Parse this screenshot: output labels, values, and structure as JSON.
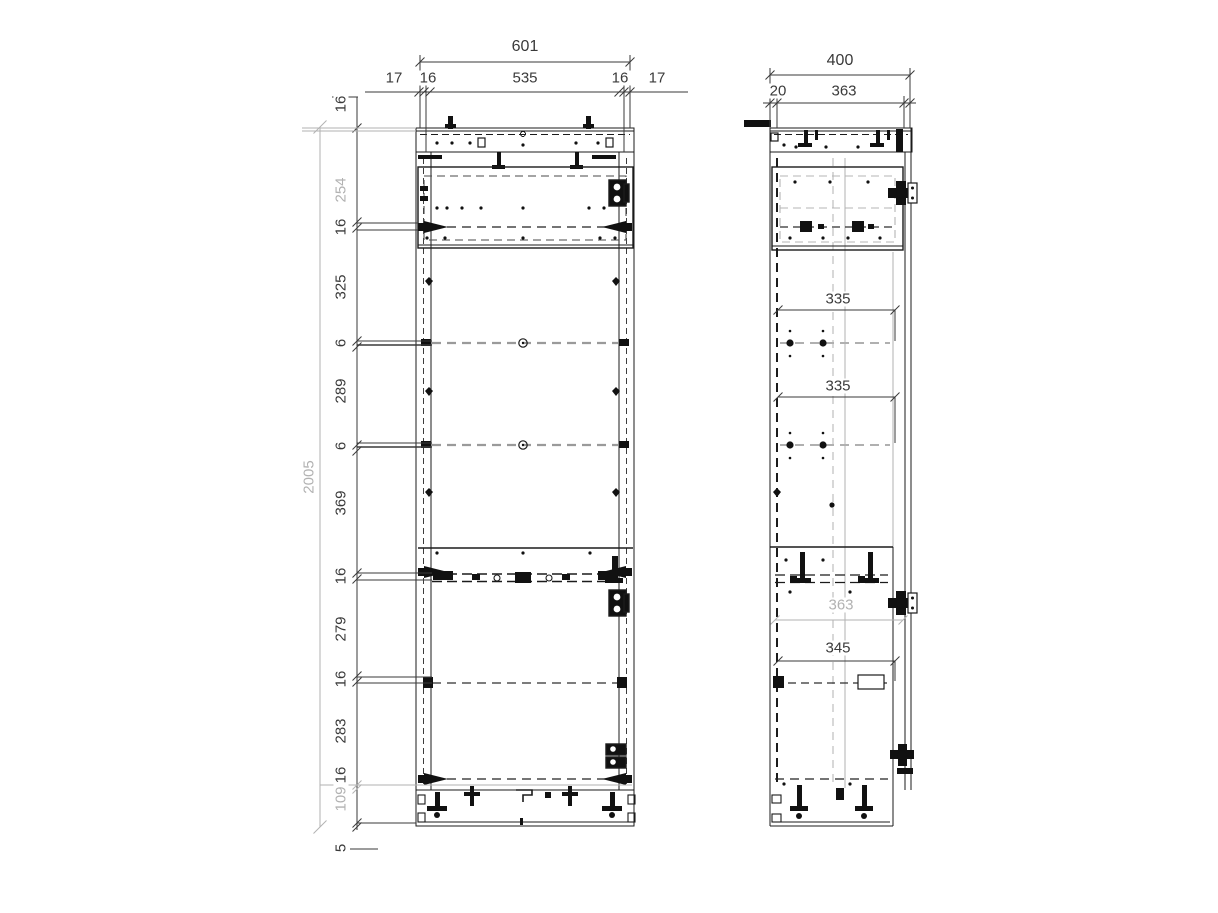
{
  "drawing_type": "cabinet technical drawing, front and side elevation",
  "dimensions": {
    "front": {
      "width_total": "601",
      "top_row": {
        "overhang_left": "17",
        "panel_left": "16",
        "inner_width": "535",
        "panel_right": "16",
        "overhang_right": "17"
      },
      "top_panel_thickness": "16",
      "height_total": "2005",
      "chain": {
        "seg254": "254",
        "seg16a": "16",
        "seg325": "325",
        "seg6a": "6",
        "seg289": "289",
        "seg6b": "6",
        "seg369": "369",
        "seg16b": "16",
        "seg279": "279",
        "seg16c": "16",
        "seg283": "283",
        "seg16d": "16",
        "seg109": "109",
        "seg5": "5"
      }
    },
    "side": {
      "depth_total": "400",
      "back_offset": "20",
      "depth_inner": "363",
      "shelf_spacing_a": "335",
      "shelf_spacing_b": "335",
      "ref_depth": "363",
      "bottom_inner": "345"
    }
  },
  "colors": {
    "line": "#1b1b1b",
    "gray_line": "#ababab",
    "dim_text": "#3a3a3a",
    "dim_text_gray": "#b2b2b2"
  }
}
